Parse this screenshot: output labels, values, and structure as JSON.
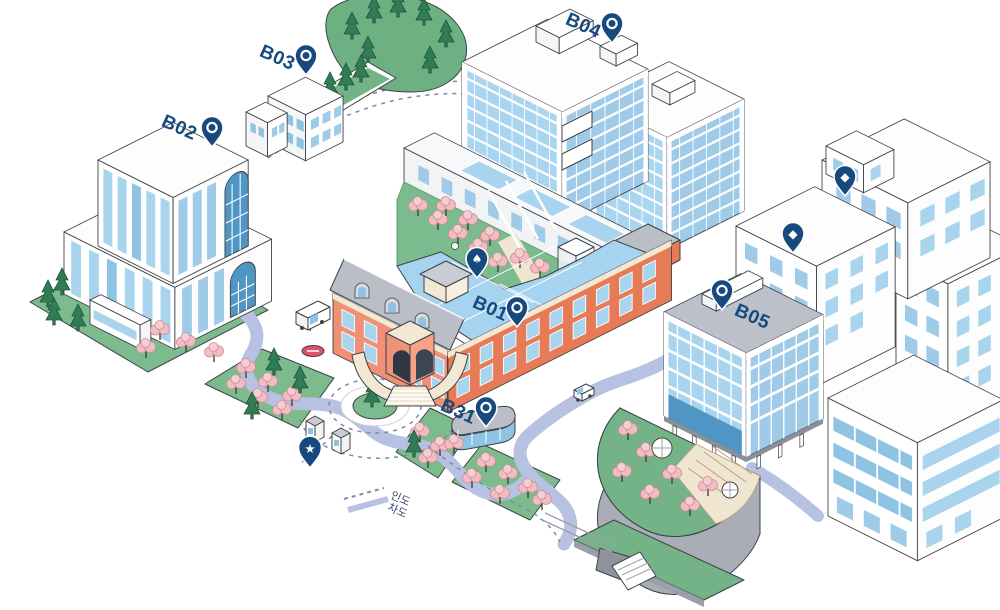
{
  "map_title": "campus-guide-map",
  "buildings": {
    "b01": {
      "label": "B01"
    },
    "b02": {
      "label": "B02"
    },
    "b03": {
      "label": "B03"
    },
    "b04": {
      "label": "B04"
    },
    "b05": {
      "label": "B05"
    },
    "b31": {
      "label": "B31"
    }
  },
  "pins": {
    "glyphs": {
      "diamond": "◆",
      "star": "★",
      "spade": "♠"
    },
    "color": "#17497e"
  },
  "legend": {
    "sidewalk": {
      "label": "인도",
      "style": "dashed"
    },
    "roadway": {
      "label": "차도",
      "style": "solid"
    }
  },
  "colors": {
    "pin_navy": "#17497e",
    "road": "#b7c1e1",
    "sidewalk_dash": "#7e89a8",
    "lawn": "#7cbb8e",
    "hill": "#6db183",
    "pine": "#2f7c55",
    "cherry": "#f3bcc2",
    "glass_light": "#aad5ef",
    "glass_mid": "#9fcbe8",
    "glass_dark": "#4f96c4",
    "roof_glass": "#a6d3f0",
    "brick_light": "#ef9077",
    "brick_dark": "#e77b58",
    "cream": "#f2e8d4",
    "gray_roof": "#b9bec7",
    "stop_red": "#e0506a"
  }
}
